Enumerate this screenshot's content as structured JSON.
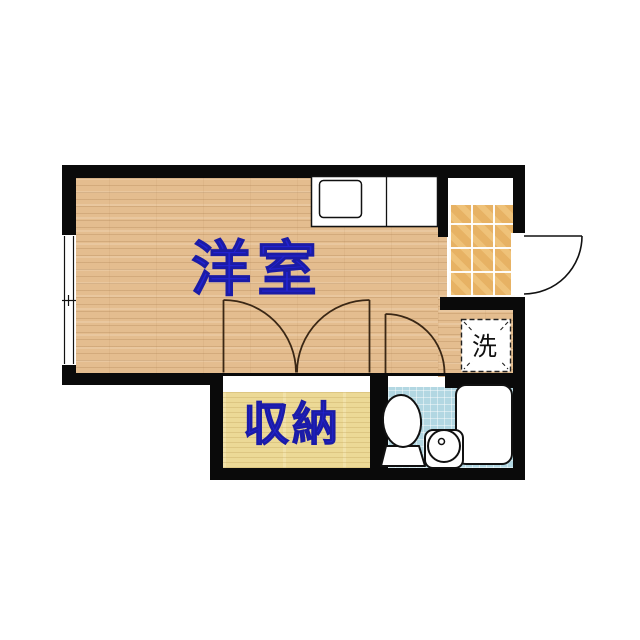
{
  "floorplan": {
    "rooms": {
      "western_room": {
        "label": "洋室"
      },
      "storage": {
        "label": "収納"
      },
      "laundry": {
        "label": "洗"
      }
    },
    "fixtures": [
      "kitchen-counter-with-sink",
      "entrance-tiled-floor",
      "entry-door-swing",
      "sliding-window",
      "double-closet-doors",
      "bathroom-door-swing",
      "washing-machine-space",
      "toilet",
      "round-wash-basin",
      "bathtub"
    ],
    "colors": {
      "wall": "#0a0a0a",
      "label_blue": "#2323cf",
      "wood_floor": "#e4bd8f",
      "entrance_tile": "#e7b264",
      "closet_floor": "#ecd996",
      "bath_floor": "#b2d7e2"
    }
  }
}
